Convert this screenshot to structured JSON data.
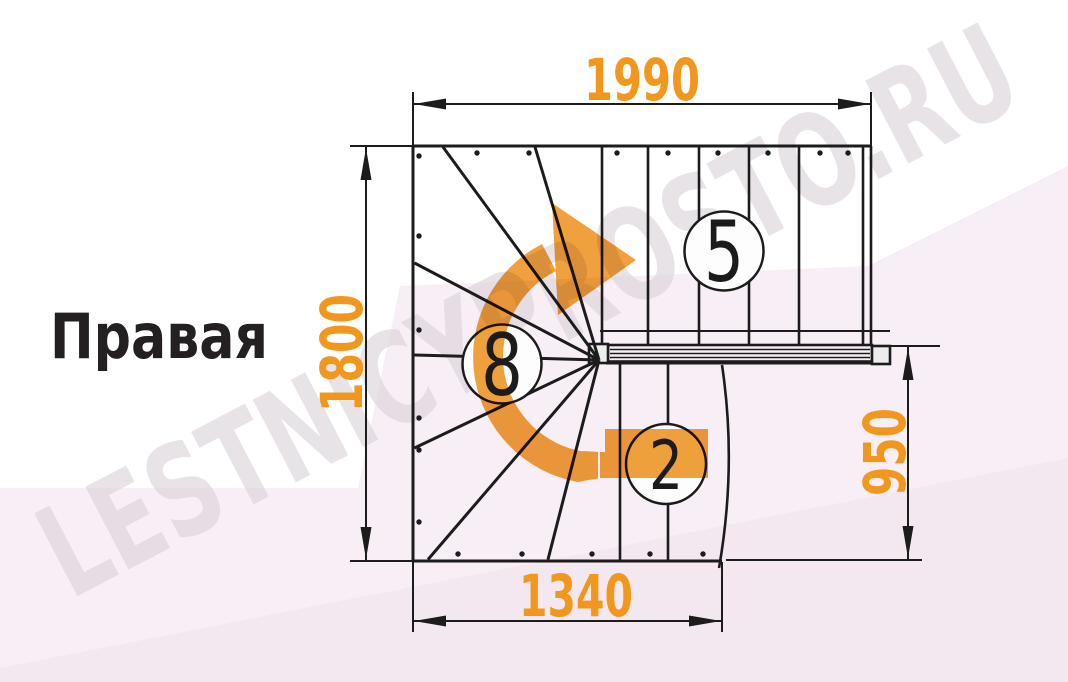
{
  "title": {
    "text": "Правая"
  },
  "watermark": {
    "text": "LESTNICYPROSTO.RU"
  },
  "dimensions": {
    "top": "1990",
    "left": "1800",
    "right": "950",
    "bottom": "1340"
  },
  "step_counts": {
    "upper_flight": "5",
    "winder": "8",
    "lower_flight": "2"
  },
  "colors": {
    "accent": "#f2971d",
    "arrow": "#ef9c33",
    "line": "#1c1c1c",
    "title": "#242021",
    "pink1": "#f8eef5",
    "pink2": "#f4e8f0",
    "wmcolor": "#d9d2d8"
  }
}
